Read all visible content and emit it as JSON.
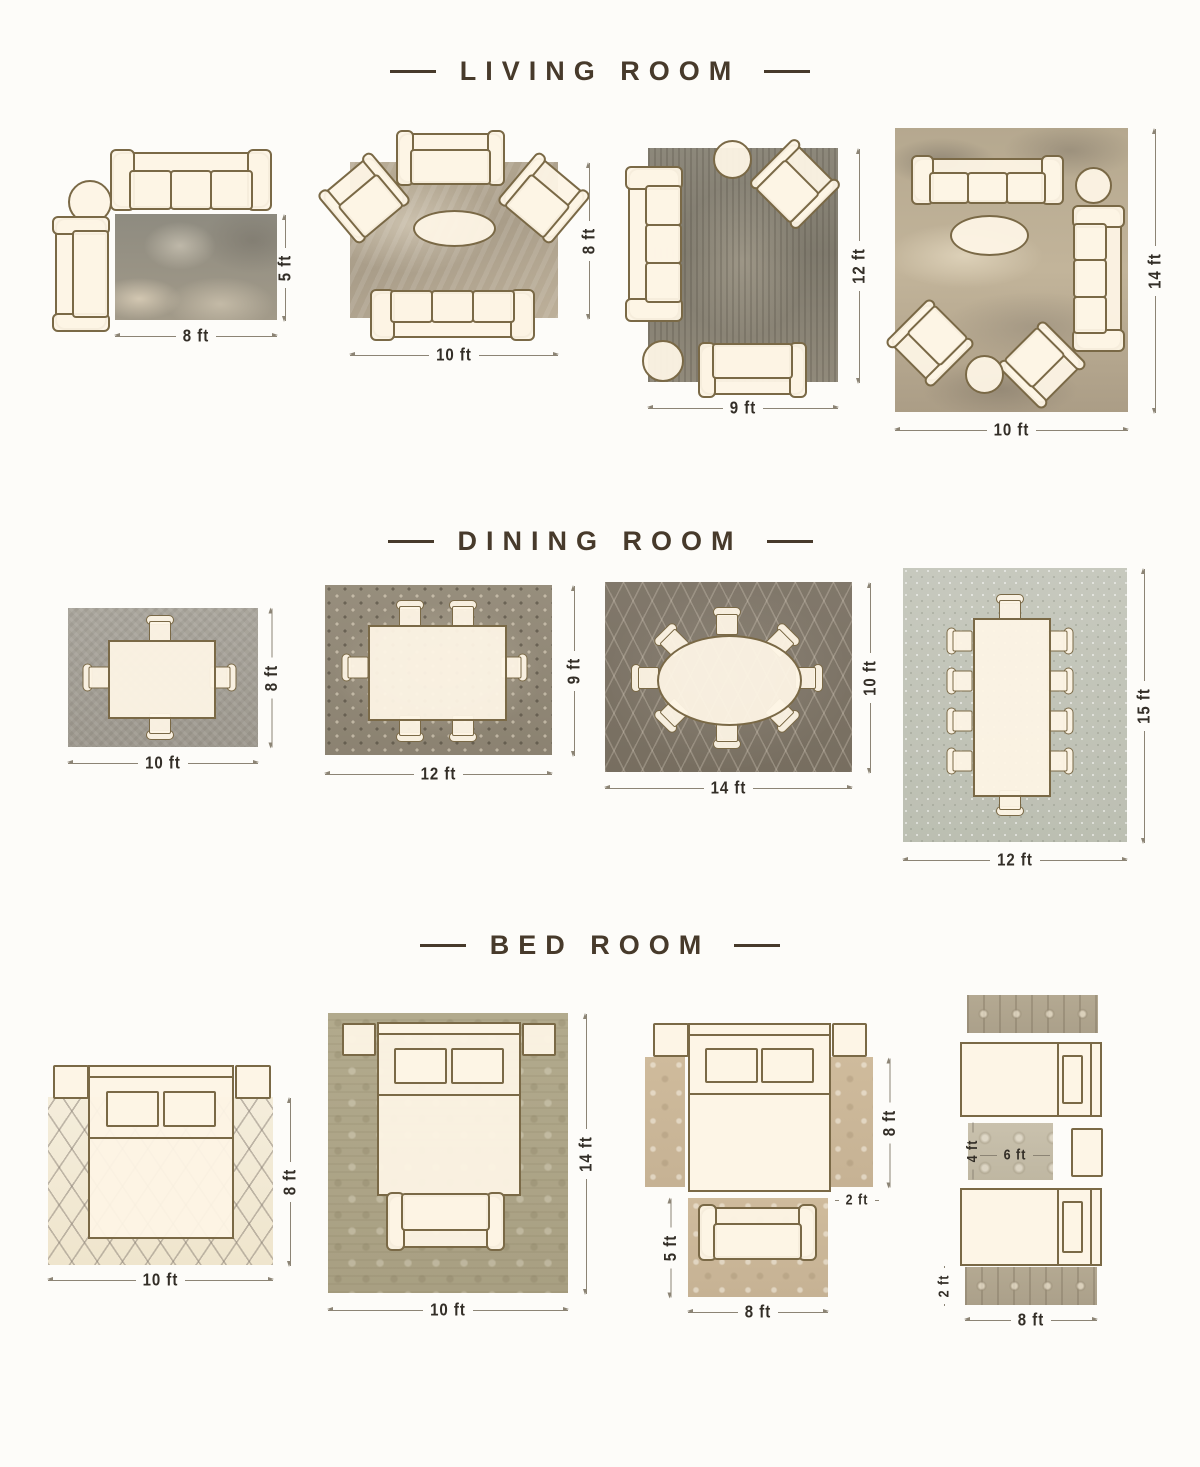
{
  "colors": {
    "background": "#fdfcf9",
    "title_text": "#473a2b",
    "dimension_text": "#332e27",
    "dimension_line": "#8c8475",
    "furniture_outline": "#7a6946",
    "furniture_fill": "#fdf4e5"
  },
  "sections": {
    "living": {
      "title": "LIVING ROOM",
      "layouts": [
        {
          "width_label": "8 ft",
          "height_label": "5 ft"
        },
        {
          "width_label": "10 ft",
          "height_label": "8 ft"
        },
        {
          "width_label": "9 ft",
          "height_label": "12 ft"
        },
        {
          "width_label": "10 ft",
          "height_label": "14 ft"
        }
      ]
    },
    "dining": {
      "title": "DINING ROOM",
      "layouts": [
        {
          "width_label": "10 ft",
          "height_label": "8 ft"
        },
        {
          "width_label": "12 ft",
          "height_label": "9 ft"
        },
        {
          "width_label": "14 ft",
          "height_label": "10 ft"
        },
        {
          "width_label": "12 ft",
          "height_label": "15 ft"
        }
      ]
    },
    "bedroom": {
      "title": "BED ROOM",
      "layouts": [
        {
          "width_label": "10 ft",
          "height_label": "8 ft"
        },
        {
          "width_label": "10 ft",
          "height_label": "14 ft"
        },
        {
          "side_runner_height_label": "8 ft",
          "side_runner_width_label": "2 ft",
          "foot_rug_height_label": "5 ft",
          "foot_rug_width_label": "8 ft"
        },
        {
          "accent_rug_height_label": "4 ft",
          "accent_rug_width_label": "6 ft",
          "runner_height_label": "2 ft",
          "runner_width_label": "8 ft"
        }
      ]
    }
  }
}
